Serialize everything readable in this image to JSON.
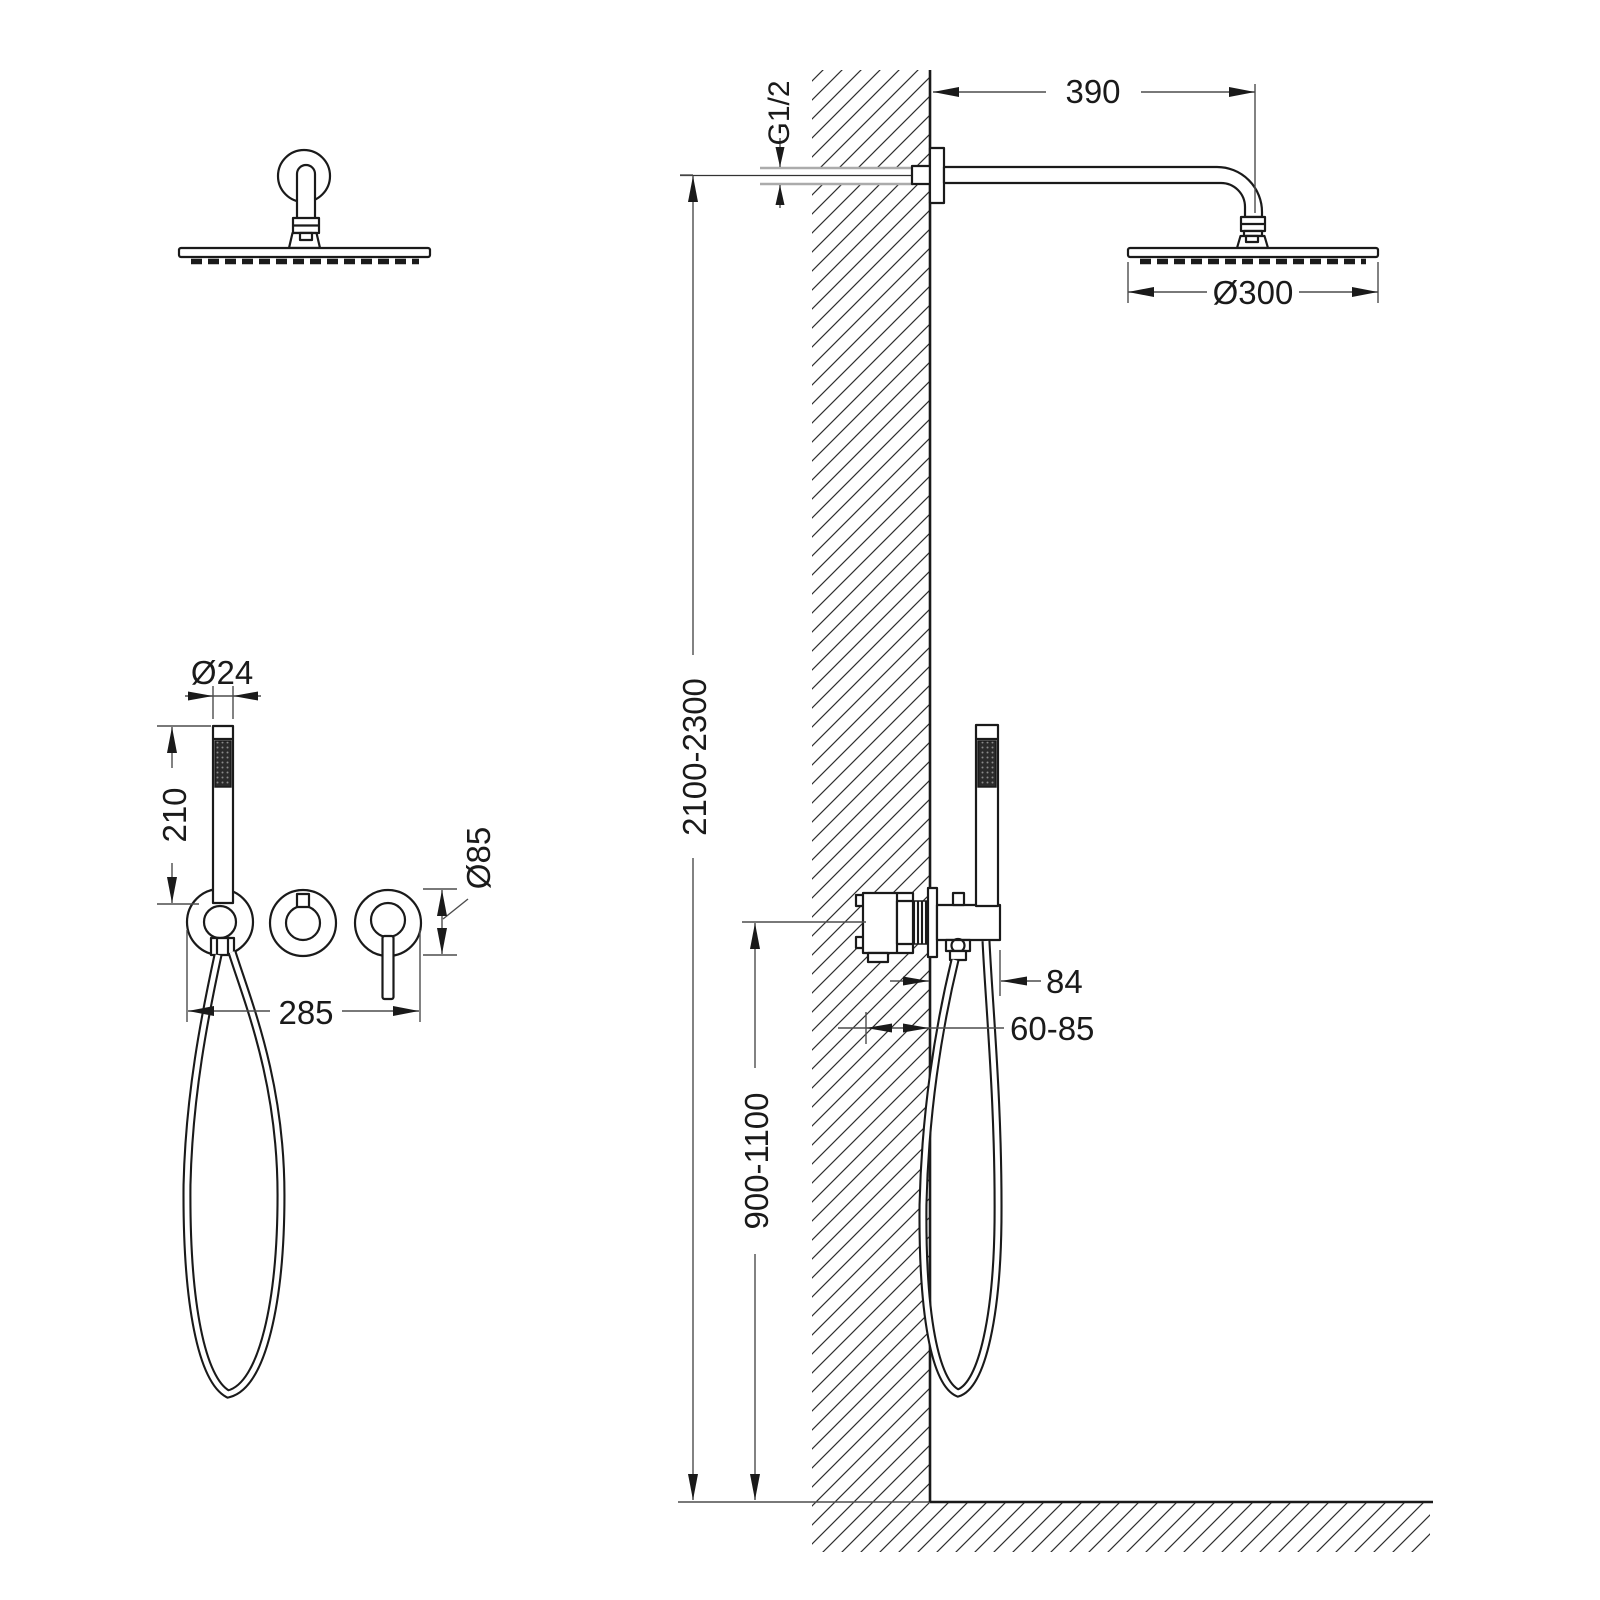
{
  "drawing": {
    "type": "shower-system-installation-diagram",
    "dimensions": {
      "arm_length": "390",
      "inlet_thread": "G1/2",
      "head_diameter": "Ø300",
      "wand_diameter": "Ø24",
      "wand_length": "210",
      "trim_diameter": "Ø85",
      "trim_width": "285",
      "holder_projection": "84",
      "rough_in_depth": "60-85",
      "install_height": "2100-2300",
      "valve_height": "900-1100"
    },
    "palette": {
      "line": "#1a1a1a",
      "dim_line": "#4d4d4d",
      "pipe_gray": "#ababab",
      "background": "#ffffff"
    }
  }
}
